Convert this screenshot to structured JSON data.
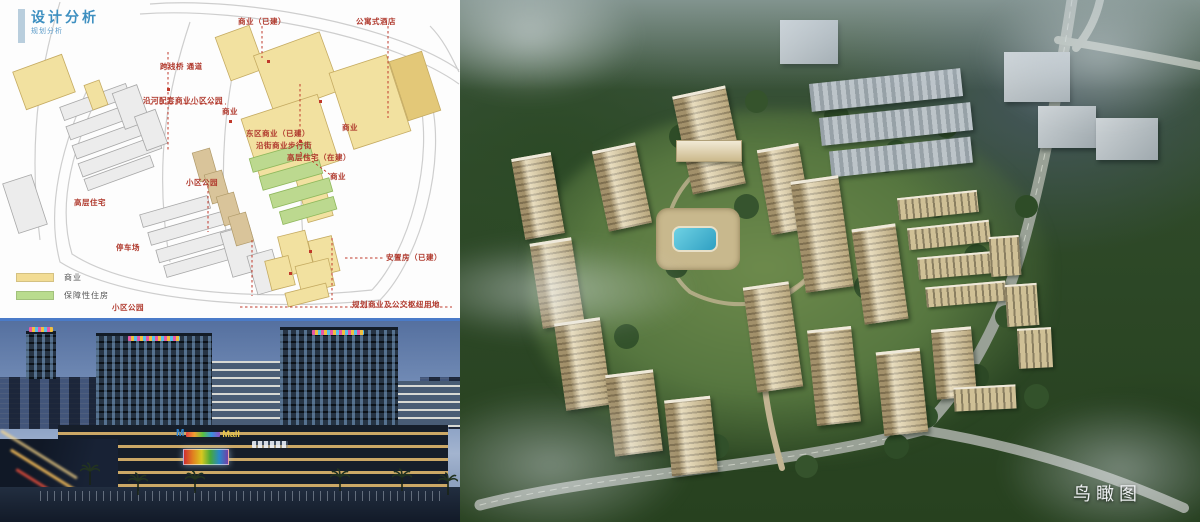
{
  "site_plan": {
    "title": "设计分析",
    "subtitle": "规划分析",
    "labels": [
      {
        "text": "商业（已建）"
      },
      {
        "text": "公寓式酒店"
      },
      {
        "text": "跨线桥 通道"
      },
      {
        "text": "沿河配套商业小区公园"
      },
      {
        "text": "商业"
      },
      {
        "text": "东区商业（已建）"
      },
      {
        "text": "沿街商业步行街"
      },
      {
        "text": "高层住宅（在建）"
      },
      {
        "text": "商业"
      },
      {
        "text": "商业"
      },
      {
        "text": "小区公园"
      },
      {
        "text": "高层住宅"
      },
      {
        "text": "停车场"
      },
      {
        "text": "小区公园"
      },
      {
        "text": "安置房（已建）"
      },
      {
        "text": "规划商业及公交枢纽用地"
      }
    ],
    "legend": [
      {
        "label": "商业",
        "color": "#f2dc94"
      },
      {
        "label": "保障性住房",
        "color": "#b9dc8e"
      }
    ]
  },
  "mall_photo": {
    "sign_initial": "M",
    "sign_main": "Mall"
  },
  "aerial": {
    "caption": "鸟瞰图"
  },
  "colors": {
    "title_blue": "#3d8fc0",
    "label_red": "#b03a2e",
    "divider_blue": "#4a7bc8",
    "commercial_yellow": "#f2e1a0",
    "affordable_green": "#bcd98f",
    "pool_blue": "#49b9d6"
  }
}
